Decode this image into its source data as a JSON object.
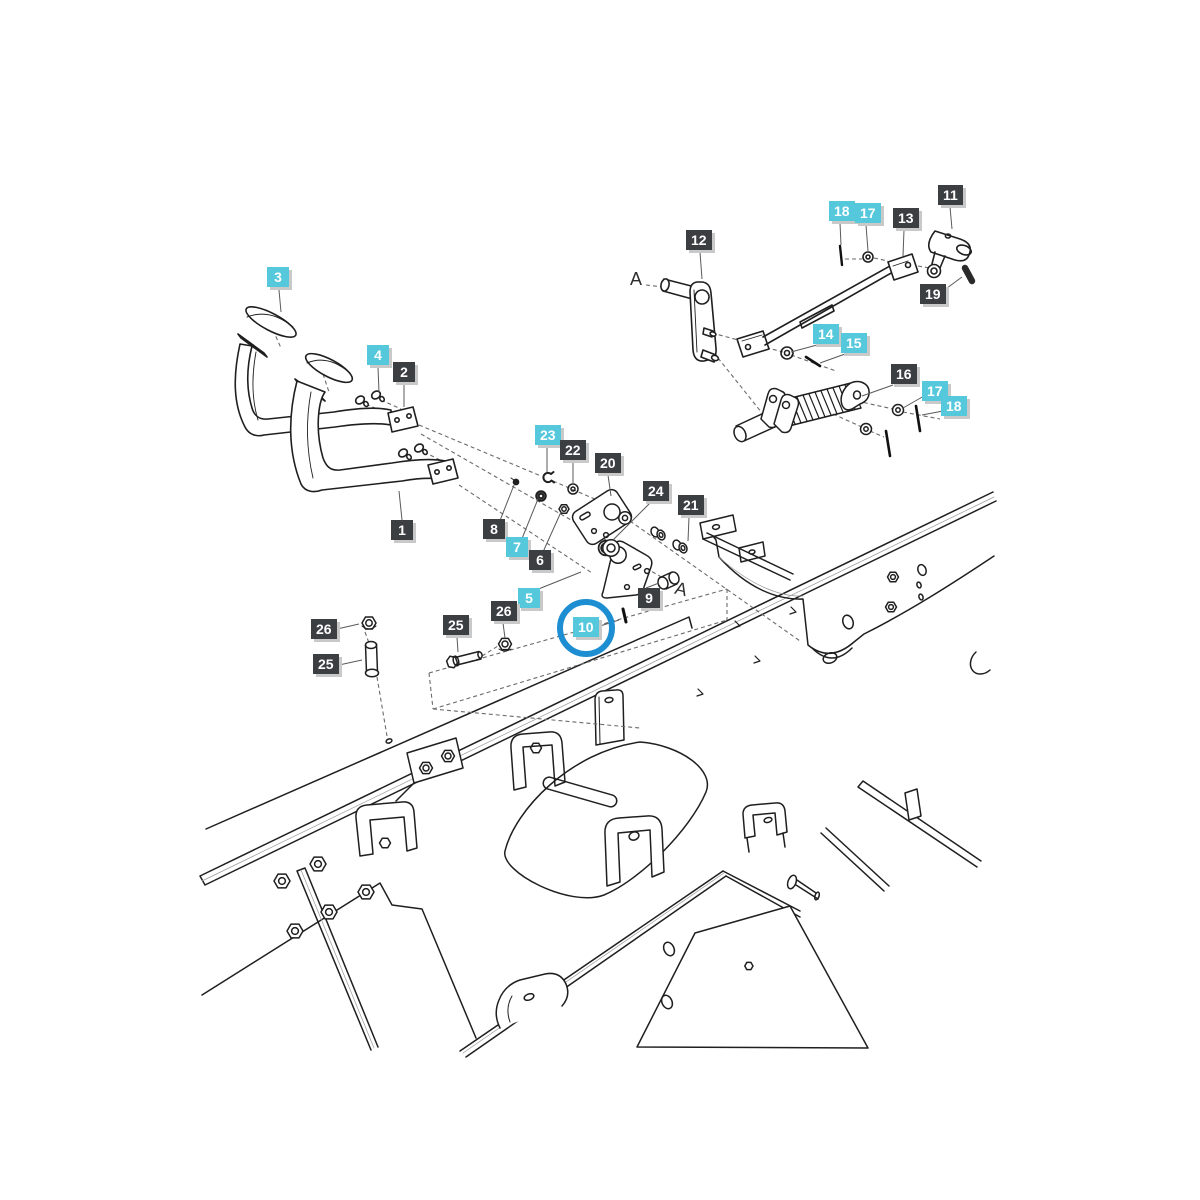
{
  "diagram": {
    "colors": {
      "dark_label_bg": "#3b3f42",
      "cyan_label_bg": "#55c8dc",
      "label_text": "#ffffff",
      "label_shadow": "#c9c9c9",
      "line": "#1f1f1f",
      "highlight_circle": "#1d8ed2"
    },
    "highlight": {
      "part": "10",
      "cx": 586,
      "cy": 628,
      "r": 23,
      "stroke": 6
    },
    "reference_letters": [
      {
        "text": "A",
        "x": 630,
        "y": 269,
        "rotate": 0
      },
      {
        "text": "A",
        "x": 675,
        "y": 579,
        "rotate": 14
      }
    ],
    "labels": [
      {
        "text": "3",
        "style": "cyan",
        "x": 267,
        "y": 267
      },
      {
        "text": "4",
        "style": "cyan",
        "x": 367,
        "y": 345
      },
      {
        "text": "2",
        "style": "dark",
        "x": 393,
        "y": 362
      },
      {
        "text": "1",
        "style": "dark",
        "x": 391,
        "y": 520
      },
      {
        "text": "23",
        "style": "cyan",
        "x": 535,
        "y": 425
      },
      {
        "text": "22",
        "style": "dark",
        "x": 560,
        "y": 440
      },
      {
        "text": "20",
        "style": "dark",
        "x": 595,
        "y": 453
      },
      {
        "text": "24",
        "style": "dark",
        "x": 643,
        "y": 481
      },
      {
        "text": "21",
        "style": "dark",
        "x": 678,
        "y": 495
      },
      {
        "text": "8",
        "style": "dark",
        "x": 483,
        "y": 519
      },
      {
        "text": "7",
        "style": "cyan",
        "x": 506,
        "y": 537
      },
      {
        "text": "6",
        "style": "dark",
        "x": 529,
        "y": 550
      },
      {
        "text": "5",
        "style": "cyan",
        "x": 518,
        "y": 588
      },
      {
        "text": "26",
        "style": "dark",
        "x": 491,
        "y": 601
      },
      {
        "text": "10",
        "style": "cyan",
        "x": 573,
        "y": 617,
        "circled": true
      },
      {
        "text": "9",
        "style": "dark",
        "x": 638,
        "y": 588
      },
      {
        "text": "25",
        "style": "dark",
        "x": 443,
        "y": 615
      },
      {
        "text": "26",
        "style": "dark",
        "x": 311,
        "y": 619
      },
      {
        "text": "25",
        "style": "dark",
        "x": 313,
        "y": 654
      },
      {
        "text": "12",
        "style": "dark",
        "x": 686,
        "y": 230
      },
      {
        "text": "18",
        "style": "cyan",
        "x": 829,
        "y": 201
      },
      {
        "text": "17",
        "style": "cyan",
        "x": 855,
        "y": 203
      },
      {
        "text": "13",
        "style": "dark",
        "x": 893,
        "y": 208
      },
      {
        "text": "11",
        "style": "dark",
        "x": 938,
        "y": 185
      },
      {
        "text": "19",
        "style": "dark",
        "x": 920,
        "y": 284
      },
      {
        "text": "14",
        "style": "cyan",
        "x": 813,
        "y": 324
      },
      {
        "text": "15",
        "style": "cyan",
        "x": 841,
        "y": 333
      },
      {
        "text": "16",
        "style": "dark",
        "x": 891,
        "y": 364
      },
      {
        "text": "17",
        "style": "cyan",
        "x": 922,
        "y": 381
      },
      {
        "text": "18",
        "style": "cyan",
        "x": 941,
        "y": 396
      }
    ]
  }
}
